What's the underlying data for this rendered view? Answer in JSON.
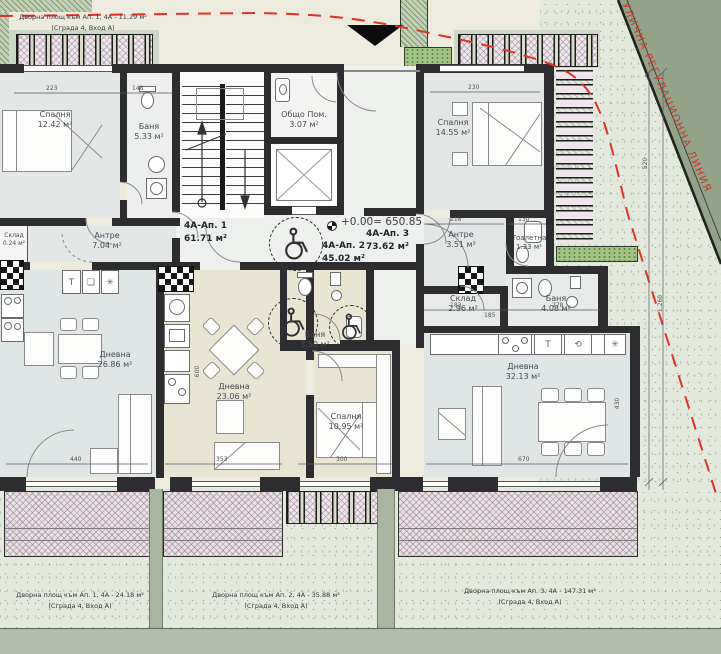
{
  "drawing": {
    "street_line_label": "УЛИЧНА РЕГУЛАЦИОННА ЛИНИЯ",
    "level_mark": "+0.00= 650.85",
    "top_yard_caption": {
      "line1": "Дворна площ към Ап. 1, 4А - 11.29 м²",
      "line2": "(Сграда 4,  Вход А)"
    }
  },
  "apartments": {
    "ap1": {
      "name": "4А-Ап. 1",
      "area": "61.71 м²"
    },
    "ap2": {
      "name": "4А-Ап. 2",
      "area": "45.02 м²"
    },
    "ap3": {
      "name": "4А-Ап. 3",
      "area": "73.62 м²"
    }
  },
  "rooms": {
    "ap1_bedroom": {
      "name": "Спалня",
      "area": "12.42 м²"
    },
    "ap1_bath": {
      "name": "Баня",
      "area": "5.33 м²"
    },
    "ap1_storage": {
      "name": "Склад",
      "area": "0.24 м²"
    },
    "ap1_hall": {
      "name": "Антре",
      "area": "7.04 м²"
    },
    "ap1_living": {
      "name": "Дневна",
      "area": "26.86 м²"
    },
    "common": {
      "name": "Общо Пом.",
      "area": "3.07 м²"
    },
    "ap2_living": {
      "name": "Дневна",
      "area": "23.06 м²"
    },
    "ap2_bedroom": {
      "name": "Спалня",
      "area": "10.95 м²"
    },
    "ap2_bath": {
      "name": "Баня",
      "area": "3.50 м²"
    },
    "ap3_bedroom": {
      "name": "Спалня",
      "area": "14.55 м²"
    },
    "ap3_hall": {
      "name": "Антре",
      "area": "3.51 м²"
    },
    "ap3_toilet": {
      "name": "Тоалетна",
      "area": "1.33 м²"
    },
    "ap3_storage": {
      "name": "Склад",
      "area": "2.96 м²"
    },
    "ap3_bath": {
      "name": "Баня",
      "area": "4.08 м²"
    },
    "ap3_living": {
      "name": "Дневна",
      "area": "32.13 м²"
    }
  },
  "yard_captions": {
    "ap1": {
      "line1": "Дворна площ към Ап. 1, 4А - 24.18 м²",
      "line2": "(Сграда 4,  Вход А)"
    },
    "ap2": {
      "line1": "Дворна площ към Ап. 2, 4А - 35.88 м²",
      "line2": "(Сграда 4,  Вход А)"
    },
    "ap3": {
      "line1": "Дворна площ към Ап. 3, 4А - 147.31 м²",
      "line2": "(Сграда 4,  Вход А)"
    }
  },
  "dimensions": {
    "t1": "223",
    "t2": "148",
    "t3": "230",
    "b1": "440",
    "b2": "353",
    "b3": "300",
    "b4": "670",
    "m1": "183",
    "m2": "185",
    "m3": "278",
    "h1": "218",
    "h2": "130",
    "v1": "600",
    "v2": "430",
    "r1": "520",
    "r2": "1.260"
  },
  "colors": {
    "regulation_red": "#d2342a",
    "street_band": "#93a389",
    "wall": "#2d2d2f",
    "room_beige": "#e9e5d3",
    "room_gray": "#e2e7e6",
    "yard_green": "#e3eadd",
    "terrace_hatch": "#e9e1e4"
  }
}
